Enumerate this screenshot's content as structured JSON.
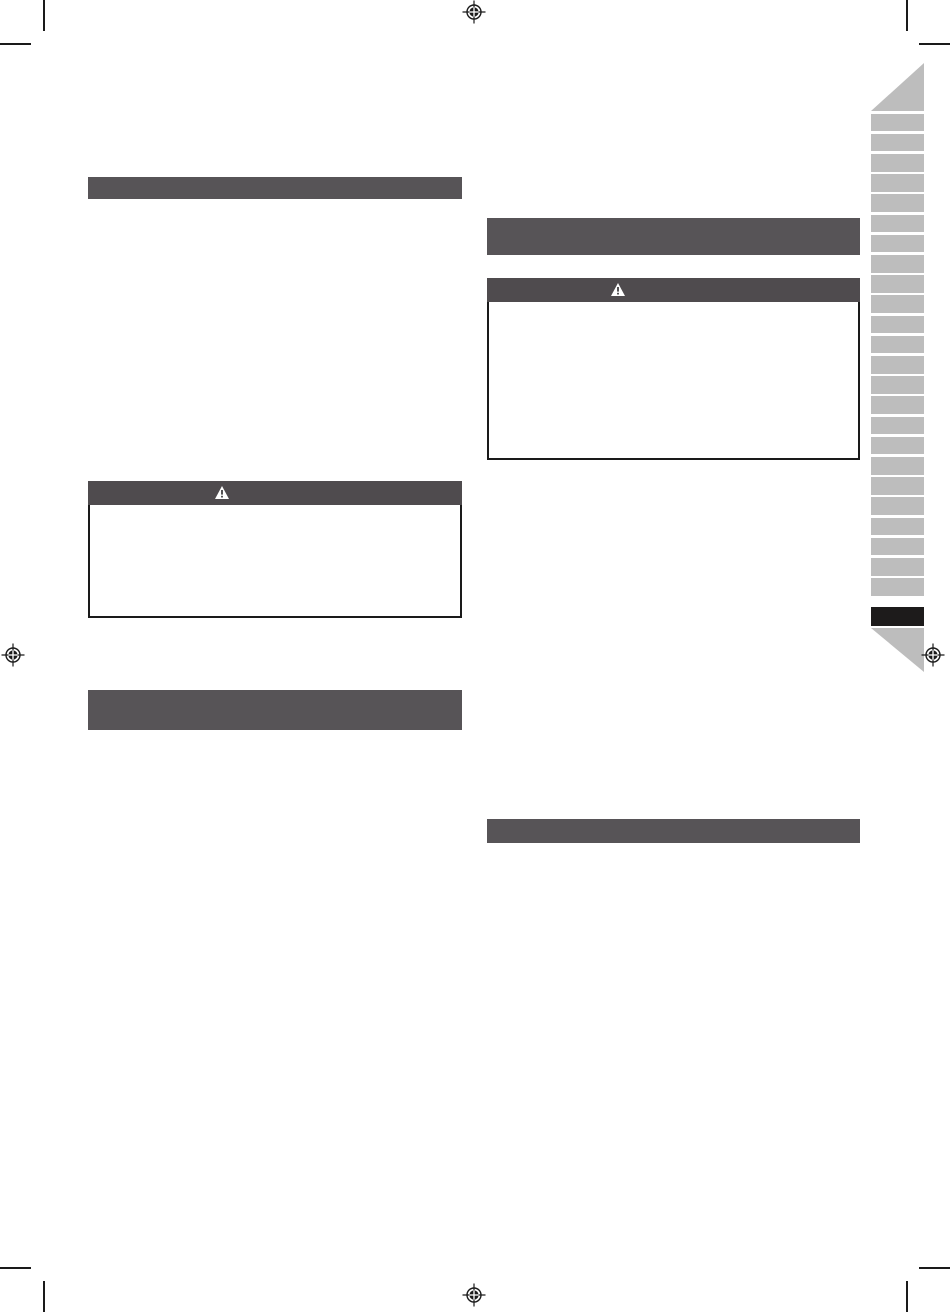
{
  "document": {
    "kind": "instruction-manual-page",
    "visible_text": "",
    "background_color": "#ffffff"
  },
  "colors": {
    "bar": "#575457",
    "warnhead": "#4f4b4e",
    "border": "#1a1a1a",
    "tab": "#bdbdbd",
    "tabactive": "#1d1b1b",
    "mark": "#1a1a1a",
    "paper": "#ffffff"
  },
  "sections": {
    "left_column": {
      "header_bars": [
        {
          "label": "",
          "height": 22
        },
        {
          "label": "",
          "height": 40
        }
      ],
      "warning_box": {
        "header_label": "",
        "icon": "warning-triangle-icon",
        "body_text": ""
      }
    },
    "right_column": {
      "header_bars": [
        {
          "label": "",
          "height": 37
        },
        {
          "label": "",
          "height": 24
        }
      ],
      "warning_box": {
        "header_label": "",
        "icon": "warning-triangle-icon",
        "body_text": ""
      }
    }
  },
  "tab_strip": {
    "tab_count": 25,
    "inactive_count": 24,
    "active_index": 24,
    "first_tab_top": 113.5,
    "tab_height": 17.8,
    "tab_period": 20.2,
    "active_tab_top": 607,
    "active_tab_height": 19
  },
  "print_marks": {
    "registration_marks": [
      "top-center",
      "left-middle",
      "right-middle",
      "bottom-center"
    ],
    "corner_crop_marks": [
      "top-left",
      "top-right",
      "bottom-left",
      "bottom-right"
    ]
  }
}
